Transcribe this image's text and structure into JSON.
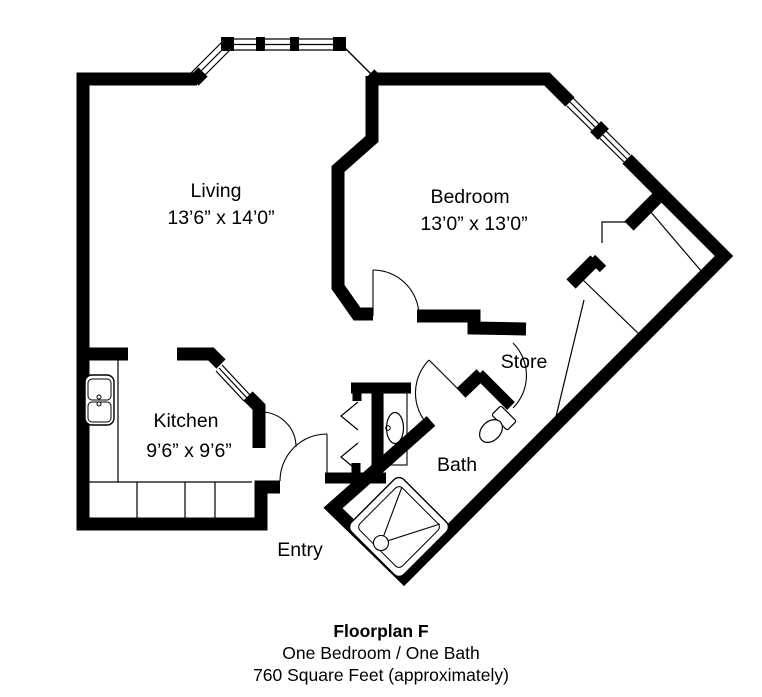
{
  "plan": {
    "rooms": [
      {
        "name": "Living",
        "dimensions": "13’6” x 14’0”"
      },
      {
        "name": "Bedroom",
        "dimensions": "13’0” x 13’0”"
      },
      {
        "name": "Kitchen",
        "dimensions": "9’6” x 9’6”"
      },
      {
        "name": "Store",
        "dimensions": ""
      },
      {
        "name": "Bath",
        "dimensions": ""
      },
      {
        "name": "Entry",
        "dimensions": ""
      }
    ],
    "fixtures": [
      "kitchen-sink",
      "vanity-sink",
      "toilet",
      "shower",
      "bay-window",
      "bedroom-window",
      "pass-through-window",
      "bifold-closet-doors"
    ]
  },
  "caption": {
    "title": "Floorplan F",
    "subtitle": "One Bedroom / One Bath",
    "area": "760 Square Feet (approximately)"
  },
  "colors": {
    "wall": "#000000",
    "background": "#ffffff"
  }
}
